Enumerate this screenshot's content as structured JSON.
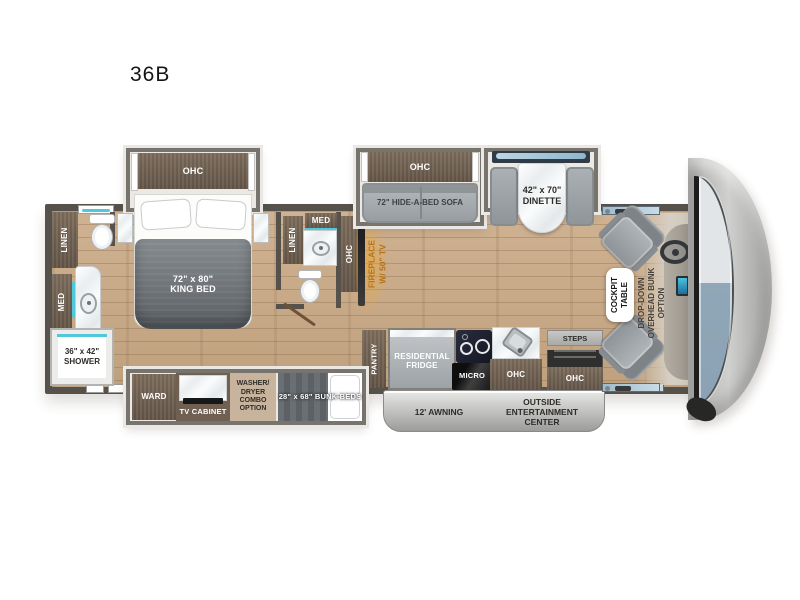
{
  "title": "36B",
  "plan": {
    "bedroom_slide_ohc": "OHC",
    "king_bed_size": "72\" x 80\"",
    "king_bed_name": "KING BED",
    "rear_bath_linen": "LINEN",
    "rear_bath_med": "MED",
    "shower_size": "36\" x 42\"",
    "shower_name": "SHOWER",
    "mid_bath_med": "MED",
    "mid_bath_linen": "LINEN",
    "mid_bath_ohc": "OHC",
    "fireplace_l1": "FIREPLACE",
    "fireplace_l2": "W/ 50\" TV",
    "ward": "WARD",
    "tv_cabinet": "TV CABINET",
    "washer_l1": "WASHER/",
    "washer_l2": "DRYER",
    "washer_l3": "COMBO",
    "washer_l4": "OPTION",
    "bunk_beds": "28\" x 68\" BUNK BEDS",
    "sofa_slide_ohc": "OHC",
    "sofa": "72\" HIDE-A-BED SOFA",
    "dinette_size": "42\" x 70\"",
    "dinette_name": "DINETTE",
    "pantry": "PANTRY",
    "fridge_l1": "RESIDENTIAL",
    "fridge_l2": "FRIDGE",
    "micro": "MICRO",
    "kitchen_ohc": "OHC",
    "steps": "STEPS",
    "entry_ohc": "OHC",
    "awning": "12' AWNING",
    "outside_l1": "OUTSIDE",
    "outside_l2": "ENTERTAINMENT",
    "outside_l3": "CENTER",
    "cockpit_table_l1": "COCKPIT",
    "cockpit_table_l2": "TABLE",
    "bunk_option_l1": "DROP-DOWN",
    "bunk_option_l2": "OVERHEAD BUNK",
    "bunk_option_l3": "OPTION"
  },
  "colors": {
    "accent_teal": "#4fc8dc",
    "accent_amber": "#b5731a",
    "wood_floor": "#c8ab88",
    "wall": "#56514b",
    "cabinet": "#6f6052",
    "upholstery": "#9aa0a4",
    "windshield_blue": "#90a7b8"
  }
}
